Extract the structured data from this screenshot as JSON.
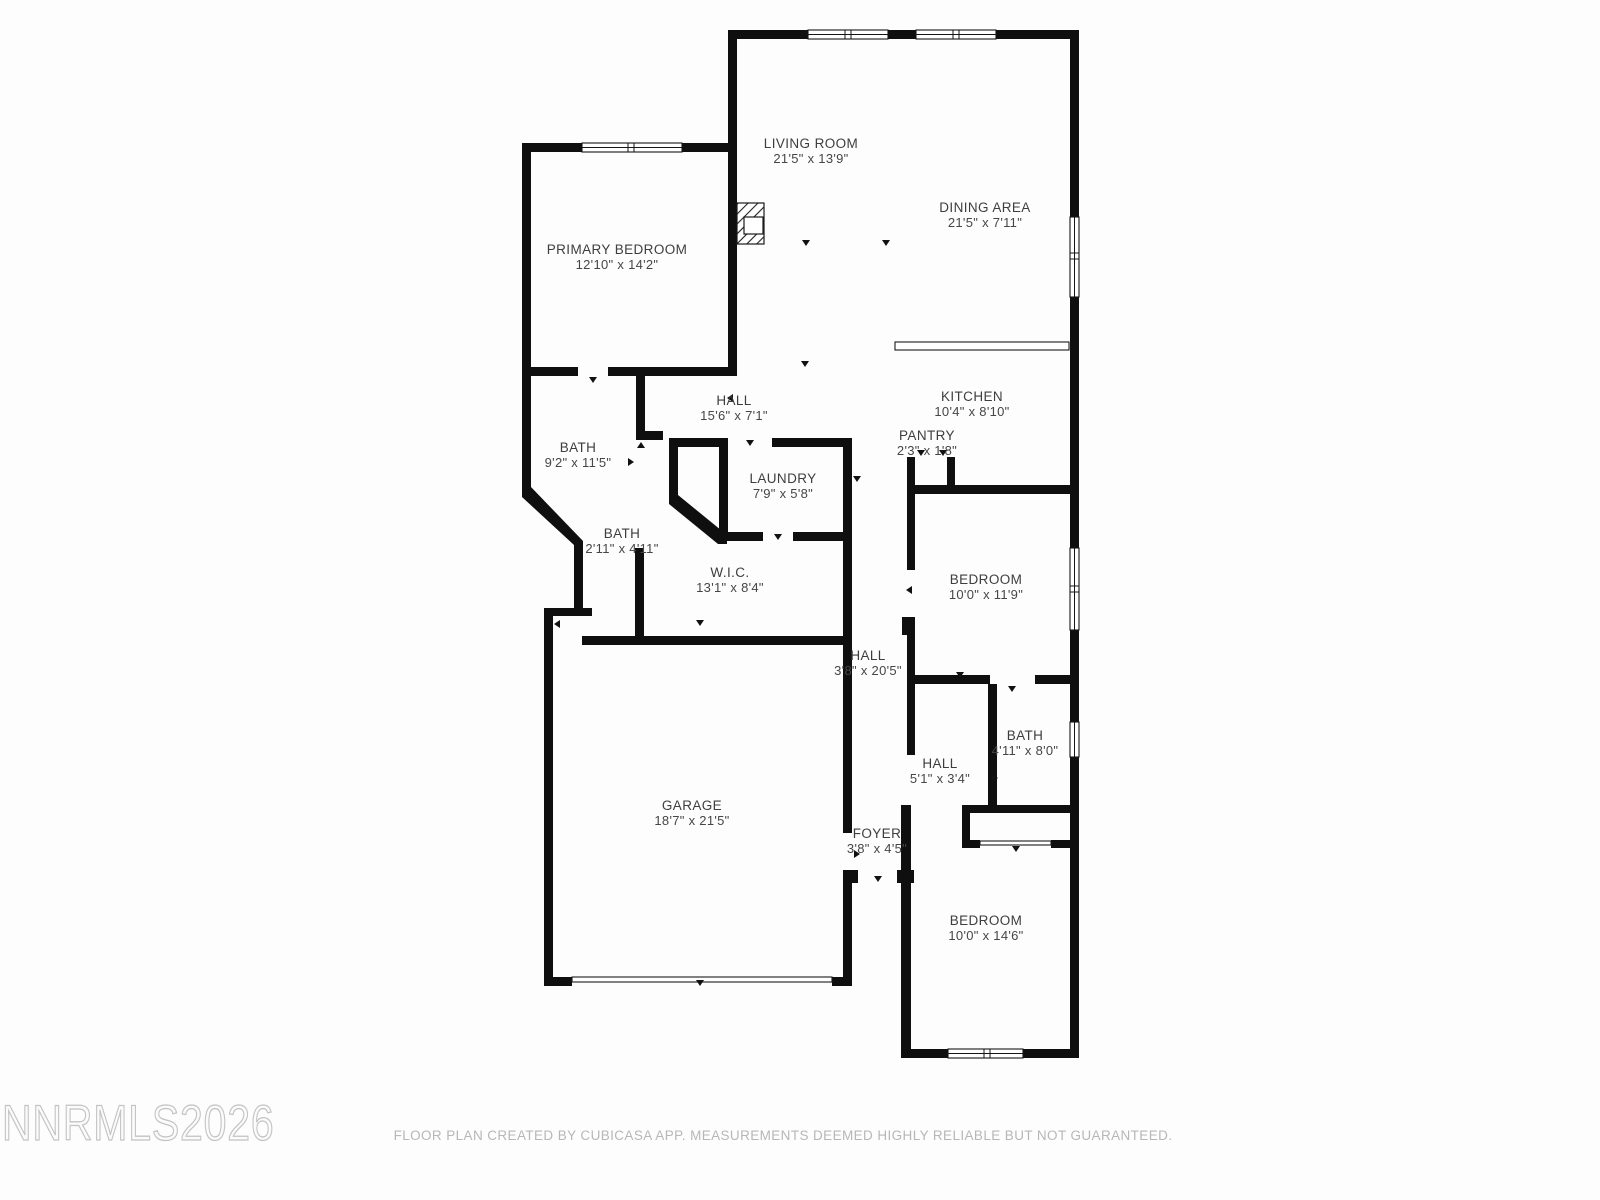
{
  "watermark": "NNRMLS2026",
  "disclaimer": "FLOOR PLAN CREATED BY CUBICASA APP. MEASUREMENTS DEEMED HIGHLY RELIABLE BUT NOT GUARANTEED.",
  "rooms": [
    {
      "name": "LIVING ROOM",
      "dims": "21'5\" x 13'9\"",
      "x": 811,
      "y": 143
    },
    {
      "name": "DINING AREA",
      "dims": "21'5\" x 7'11\"",
      "x": 985,
      "y": 207
    },
    {
      "name": "PRIMARY BEDROOM",
      "dims": "12'10\" x 14'2\"",
      "x": 617,
      "y": 249
    },
    {
      "name": "HALL",
      "dims": "15'6\" x 7'1\"",
      "x": 734,
      "y": 400
    },
    {
      "name": "KITCHEN",
      "dims": "10'4\" x 8'10\"",
      "x": 972,
      "y": 396
    },
    {
      "name": "BATH",
      "dims": "9'2\" x 11'5\"",
      "x": 578,
      "y": 447
    },
    {
      "name": "PANTRY",
      "dims": "2'3\" x 1'8\"",
      "x": 927,
      "y": 435
    },
    {
      "name": "LAUNDRY",
      "dims": "7'9\" x 5'8\"",
      "x": 783,
      "y": 478
    },
    {
      "name": "BATH",
      "dims": "2'11\" x 4'11\"",
      "x": 622,
      "y": 533
    },
    {
      "name": "W.I.C.",
      "dims": "13'1\" x 8'4\"",
      "x": 730,
      "y": 572
    },
    {
      "name": "BEDROOM",
      "dims": "10'0\" x 11'9\"",
      "x": 986,
      "y": 579
    },
    {
      "name": "HALL",
      "dims": "3'8\" x 20'5\"",
      "x": 868,
      "y": 655
    },
    {
      "name": "BATH",
      "dims": "4'11\" x 8'0\"",
      "x": 1025,
      "y": 735
    },
    {
      "name": "HALL",
      "dims": "5'1\" x 3'4\"",
      "x": 940,
      "y": 763
    },
    {
      "name": "GARAGE",
      "dims": "18'7\" x 21'5\"",
      "x": 692,
      "y": 805
    },
    {
      "name": "FOYER",
      "dims": "3'8\" x 4'5\"",
      "x": 877,
      "y": 833
    },
    {
      "name": "BEDROOM",
      "dims": "10'0\" x 14'6\"",
      "x": 986,
      "y": 920
    }
  ]
}
